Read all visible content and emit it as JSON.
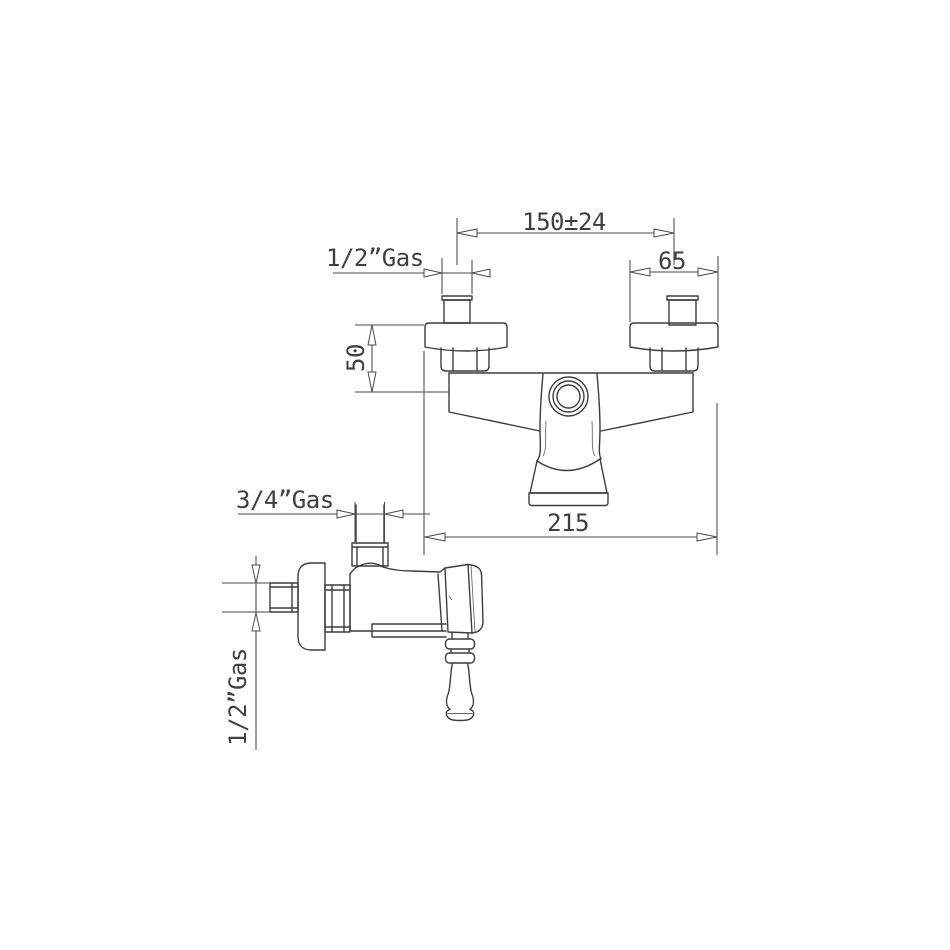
{
  "drawing": {
    "kind": "technical dimension drawing",
    "subject": "wall-mounted shower mixer tap, front and side elevation",
    "background": "#ffffff",
    "line_color": "#3d3d3d",
    "dimension_line_color": "#4a4a4a",
    "text_color": "#3f3f3f",
    "views": [
      "front elevation",
      "side elevation"
    ],
    "dimensions": {
      "center_distance": {
        "label": "150±24"
      },
      "inlet_thread_front": {
        "label": "1/2”Gas"
      },
      "flange_width": {
        "label": "65"
      },
      "drop_height": {
        "label": "50"
      },
      "overall_width": {
        "label": "215"
      },
      "outlet_thread_side": {
        "label": "3/4”Gas"
      },
      "inlet_thread_side": {
        "label": "1/2”Gas"
      }
    }
  }
}
